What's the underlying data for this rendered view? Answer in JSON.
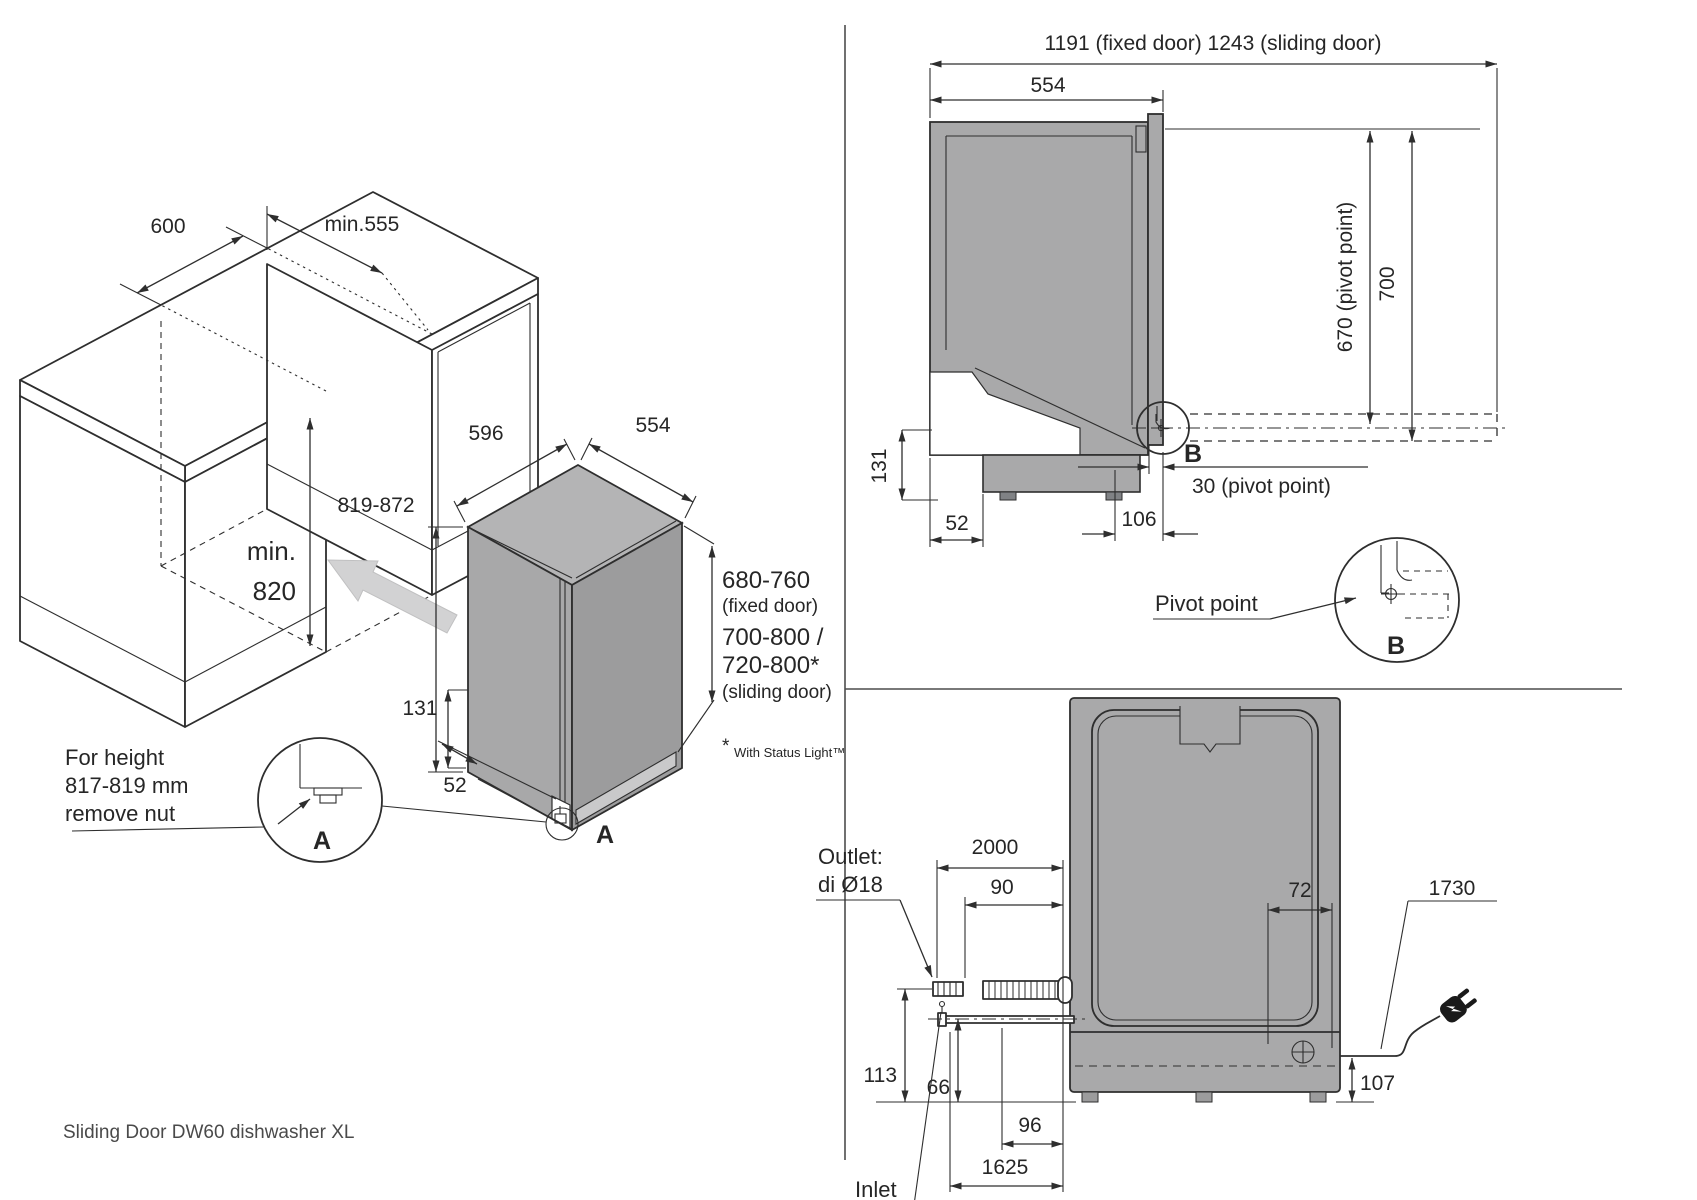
{
  "caption": "Sliding Door DW60 dishwasher XL",
  "colors": {
    "line": "#2e2e2e",
    "body_gray": "#a9a9aa",
    "top_gray": "#b4b4b5",
    "side_gray": "#9c9c9d",
    "kick_gray": "#c9c9ca",
    "arrow_gray": "#d2d2d3"
  },
  "installation_view": {
    "cabinet_width": "600",
    "niche_depth": "min.555",
    "niche_height_1": "min.",
    "niche_height_2": "820",
    "unit_height": "819-872",
    "unit_width": "596",
    "unit_depth": "554",
    "plinth_height": "131",
    "toe_depth": "52",
    "fixed_door_range": "680-760",
    "fixed_door_label": "(fixed door)",
    "sliding_door_range_1": "700-800 /",
    "sliding_door_range_2": "720-800*",
    "sliding_door_label": "(sliding door)",
    "detail_ref": "A",
    "detail_circle_label": "A",
    "height_note_1": "For height",
    "height_note_2": "817-819 mm",
    "height_note_3": "remove nut",
    "footnote_star": "*",
    "footnote_text": "With Status Light™"
  },
  "side_view": {
    "overall_depth": "1191 (fixed door) 1243 (sliding door)",
    "body_depth": "554",
    "pivot_height": "670 (pivot point)",
    "door_height": "700",
    "plinth_height": "131",
    "toe_depth": "52",
    "pivot_to_front": "106",
    "pivot_offset": "30 (pivot point)",
    "detail_ref": "B",
    "detail_circle_label": "B",
    "pivot_label": "Pivot point"
  },
  "rear_view": {
    "outlet_hose_length": "2000",
    "outlet_protrusion": "90",
    "cord_offset": "72",
    "cord_length": "1730",
    "outlet_height": "113",
    "inlet_height": "66",
    "inlet_protrusion": "96",
    "inlet_hose_length": "1625",
    "cord_height": "107",
    "outlet_label_1": "Outlet:",
    "outlet_label_2": "di Ø18",
    "inlet_label": "Inlet"
  }
}
